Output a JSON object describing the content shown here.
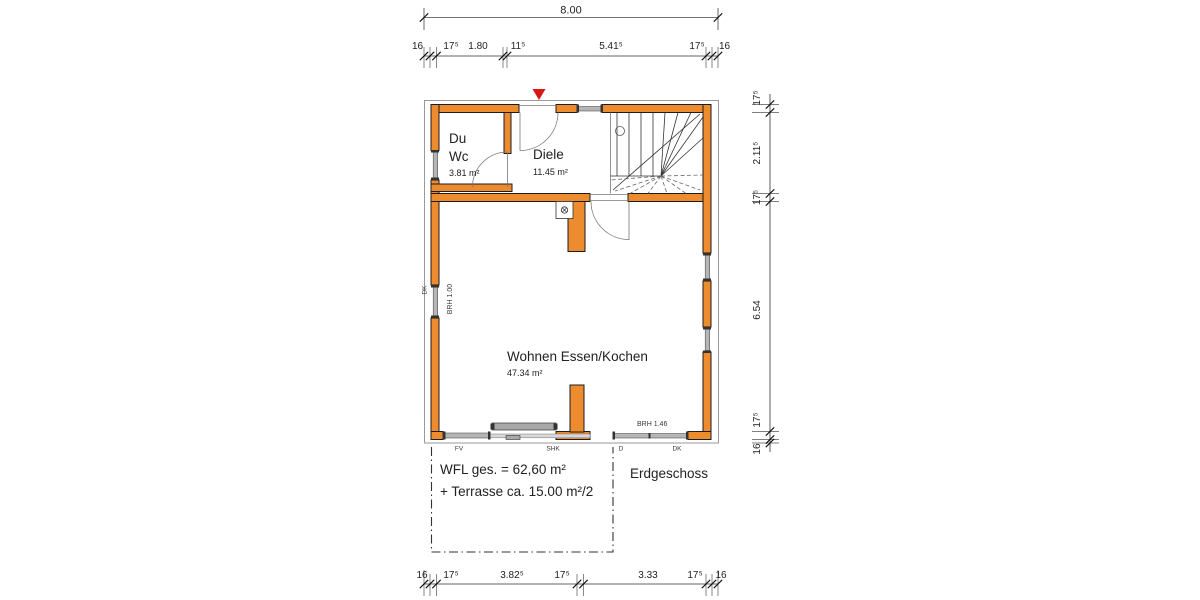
{
  "dims": {
    "top_total": "8.00",
    "top": [
      "16",
      "17⁵",
      "1.80",
      "11⁵",
      "5.41⁵",
      "17⁵",
      "16"
    ],
    "right": [
      "17⁵",
      "2.11⁵",
      "17⁵",
      "6.54",
      "17⁵",
      "16"
    ],
    "bottom": [
      "16",
      "17⁵",
      "3.82⁵",
      "17⁵",
      "3.33",
      "17⁵",
      "16"
    ]
  },
  "rooms": {
    "duwc": {
      "name1": "Du",
      "name2": "Wc",
      "area": "3.81 m²"
    },
    "diele": {
      "name": "Diele",
      "area": "11.45 m²"
    },
    "wohnen": {
      "name": "Wohnen Essen/Kochen",
      "area": "47.34 m²"
    }
  },
  "summary": {
    "wfl": "WFL ges. = 62,60 m²",
    "terrasse": "+ Terrasse ca. 15.00 m²/2",
    "floor": "Erdgeschoss"
  },
  "annotations": {
    "brh_window": "BRH 1.00",
    "brh_door": "BRH 1.46",
    "dk_left": "DK",
    "openings": [
      "FV",
      "SHK",
      "D",
      "DK"
    ]
  },
  "colors": {
    "wall": "#ED8B2F",
    "arrow": "#D81616"
  }
}
